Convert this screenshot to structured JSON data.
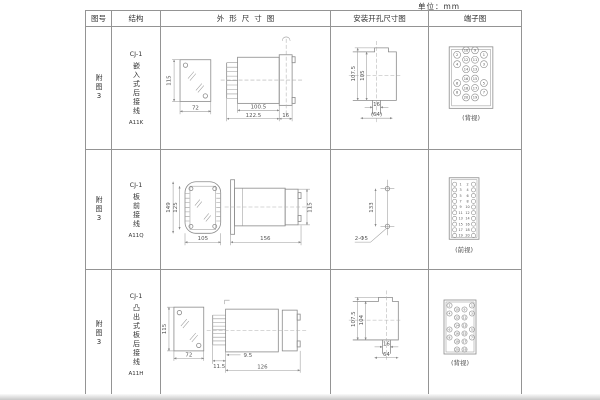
{
  "unit_label": "单位：mm",
  "header": {
    "fig": "图号",
    "struct": "结构",
    "outline": "外形尺寸图",
    "mounting": "安装开孔尺寸图",
    "terminal": "端子图"
  },
  "rows": [
    {
      "fig": "附图3",
      "struct_line1": "CJ-1",
      "struct_name": "嵌入式后接线",
      "struct_model": "A11K",
      "outline": {
        "front_h": "115",
        "front_w": "72",
        "body_len": "100.5",
        "total_len": "122.5",
        "flange_w": "16"
      },
      "mounting": {
        "outer_h": "107.5",
        "inner_h": "105",
        "slot_w": "16",
        "span": "(64)"
      },
      "terminal": {
        "caption": "(背视)",
        "grid": [
          [
            "2",
            "10",
            "9",
            "1"
          ],
          [
            "4",
            "12",
            "11",
            "3"
          ],
          [
            "",
            "14",
            "13",
            ""
          ],
          [
            "6",
            "16",
            "15",
            "5"
          ],
          [
            "8",
            "18",
            "17",
            "7"
          ],
          [
            "",
            "20",
            "19",
            ""
          ]
        ]
      }
    },
    {
      "fig": "附图3",
      "struct_line1": "CJ-1",
      "struct_name": "板前接线",
      "struct_model": "A11Q",
      "outline": {
        "front_h_outer": "149",
        "front_h_inner": "125",
        "front_w": "105",
        "side_len": "156",
        "side_h": "115"
      },
      "mounting": {
        "hole_dist": "133",
        "holes": "2-Φ5"
      },
      "terminal": {
        "caption": "(前视)",
        "left": [
          "1",
          "3",
          "5",
          "7",
          "9",
          "11",
          "13",
          "15",
          "17",
          "19"
        ],
        "right": [
          "2",
          "4",
          "6",
          "8",
          "10",
          "12",
          "14",
          "16",
          "18",
          "20"
        ]
      }
    },
    {
      "fig": "附图3",
      "struct_line1": "CJ-1",
      "struct_name": "凸出式板后接线",
      "struct_model": "A11H",
      "outline": {
        "front_h": "115",
        "front_w": "72",
        "pin_len": "11.5",
        "offset": "9.5",
        "body_len": "126"
      },
      "mounting": {
        "outer_h": "107.5",
        "inner_h": "104",
        "slot_w": "16",
        "span": "64"
      },
      "terminal": {
        "caption": "(背视)",
        "grid": [
          [
            "2",
            "10",
            "9",
            "1"
          ],
          [
            "4",
            "12",
            "11",
            "3"
          ],
          [
            "",
            "14",
            "13",
            ""
          ],
          [
            "6",
            "16",
            "15",
            "5"
          ],
          [
            "8",
            "18",
            "17",
            "7"
          ],
          [
            "",
            "20",
            "19",
            ""
          ]
        ]
      }
    }
  ]
}
